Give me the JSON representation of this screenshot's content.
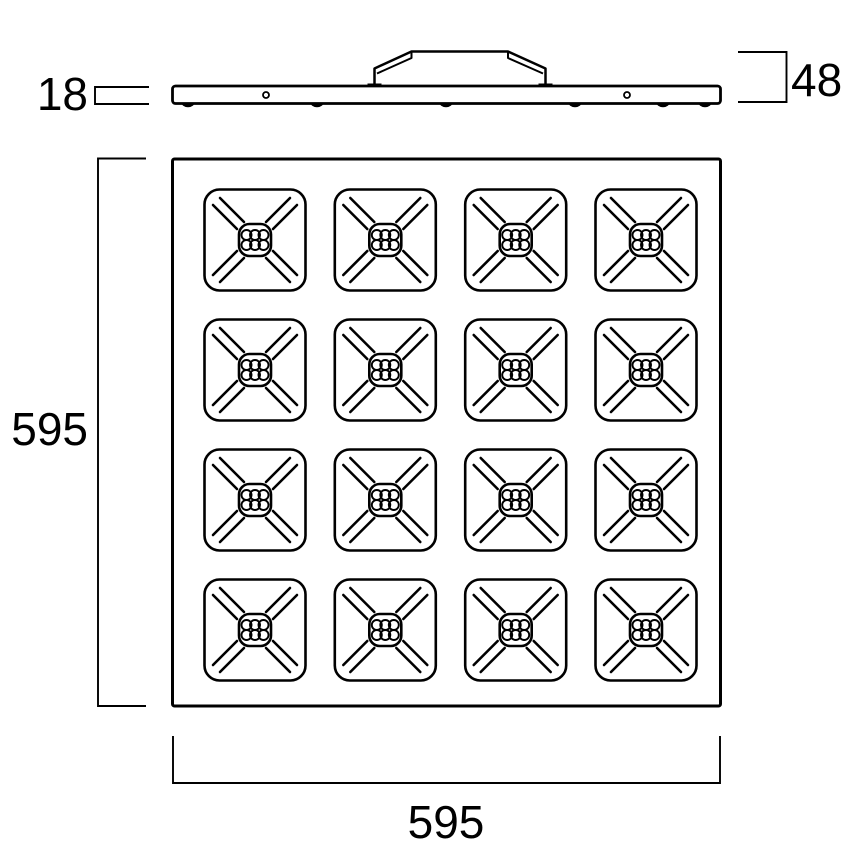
{
  "drawing": {
    "side_view": {
      "thickness_label": "18",
      "total_height_label": "48",
      "mounting_clip_count": 6,
      "face_hole_count": 2
    },
    "front_view": {
      "width_label": "595",
      "height_label": "595",
      "grid": {
        "rows": 4,
        "columns": 4,
        "cells": 16,
        "leds_per_cell": 6
      }
    },
    "colors": {
      "line": "#000000",
      "background": "#ffffff"
    }
  }
}
